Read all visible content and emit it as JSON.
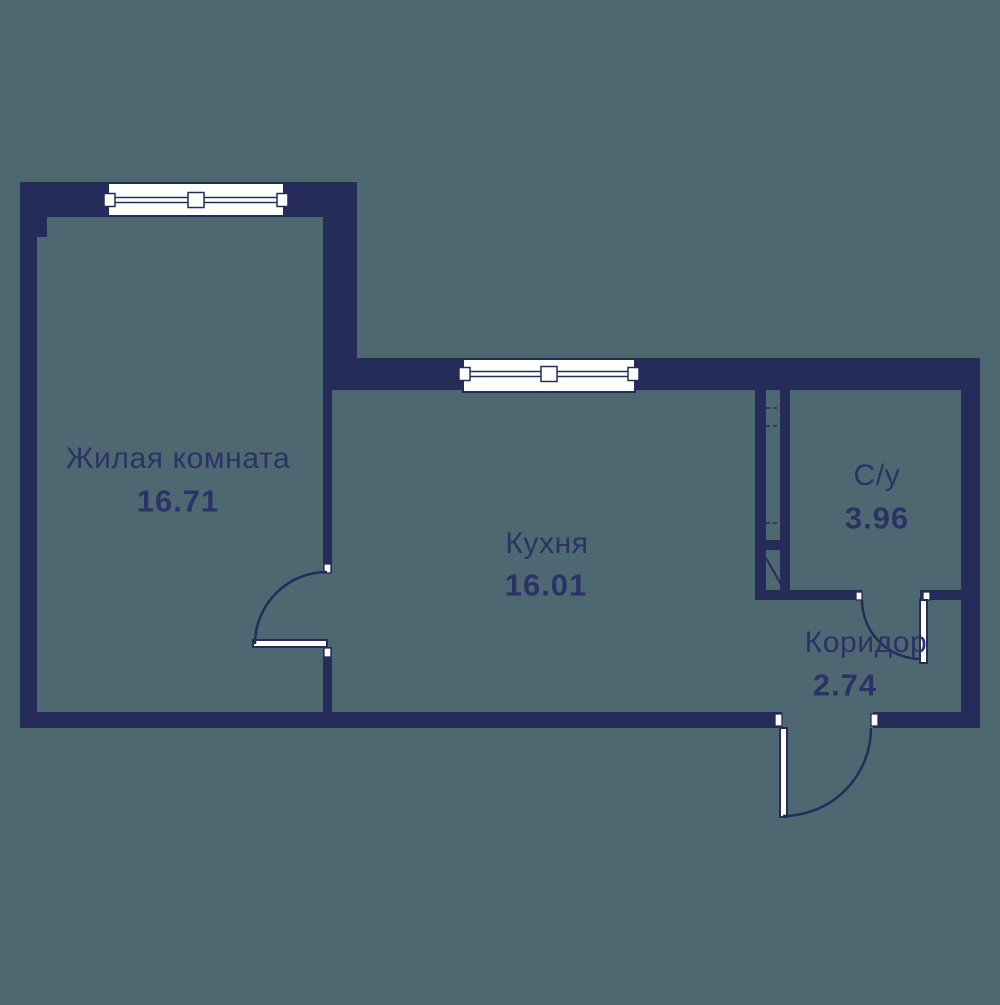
{
  "title": "Floor plan",
  "colors": {
    "background": "#4D6870",
    "wall": "#262C5A",
    "text": "#2B3366",
    "white": "#FFFFFF"
  },
  "rooms": {
    "living": {
      "name": "Жилая комната",
      "area": "16.71"
    },
    "kitchen": {
      "name": "Кухня",
      "area": "16.01"
    },
    "bath": {
      "name": "С/у",
      "area": "3.96"
    },
    "corridor": {
      "name": "Коридор",
      "area": "2.74"
    }
  },
  "plan": {
    "walls": [
      {
        "name": "wall-living-top",
        "x": 20,
        "y": 182,
        "w": 337,
        "h": 35
      },
      {
        "name": "wall-living-left",
        "x": 20,
        "y": 182,
        "w": 17,
        "h": 546
      },
      {
        "name": "wall-living-left-step",
        "x": 37,
        "y": 217,
        "w": 10,
        "h": 20
      },
      {
        "name": "wall-living-right-col",
        "x": 323,
        "y": 182,
        "w": 34,
        "h": 208
      },
      {
        "name": "wall-kitchen-top",
        "x": 323,
        "y": 358,
        "w": 657,
        "h": 32
      },
      {
        "name": "wall-divider-upper",
        "x": 323,
        "y": 390,
        "w": 9,
        "h": 183
      },
      {
        "name": "wall-divider-lower",
        "x": 323,
        "y": 647,
        "w": 9,
        "h": 65
      },
      {
        "name": "wall-bottom-left",
        "x": 20,
        "y": 712,
        "w": 762,
        "h": 16
      },
      {
        "name": "wall-bottom-right",
        "x": 873,
        "y": 712,
        "w": 107,
        "h": 16
      },
      {
        "name": "wall-right",
        "x": 961,
        "y": 390,
        "w": 19,
        "h": 338
      },
      {
        "name": "wall-shaft-left",
        "x": 755,
        "y": 390,
        "w": 11,
        "h": 210
      },
      {
        "name": "wall-shaft-right",
        "x": 780,
        "y": 390,
        "w": 10,
        "h": 210
      },
      {
        "name": "wall-shaft-bridge",
        "x": 755,
        "y": 540,
        "w": 35,
        "h": 10
      },
      {
        "name": "wall-bath-bottom-left",
        "x": 755,
        "y": 590,
        "w": 107,
        "h": 10
      },
      {
        "name": "wall-bath-bottom-right",
        "x": 920,
        "y": 590,
        "w": 60,
        "h": 10
      }
    ],
    "windows": [
      {
        "name": "window-living",
        "x": 108,
        "y": 183,
        "w": 176,
        "h": 33,
        "frame_y": 200
      },
      {
        "name": "window-kitchen",
        "x": 463,
        "y": 359,
        "w": 172,
        "h": 33,
        "frame_y": 374
      }
    ],
    "jambs": [
      {
        "name": "jamb-living-door-top",
        "x": 324,
        "y": 564,
        "w": 7,
        "h": 9
      },
      {
        "name": "jamb-living-door-bottom",
        "x": 324,
        "y": 648,
        "w": 7,
        "h": 9
      },
      {
        "name": "jamb-entrance-left",
        "x": 775,
        "y": 714,
        "w": 7,
        "h": 12
      },
      {
        "name": "jamb-entrance-right",
        "x": 871,
        "y": 714,
        "w": 7,
        "h": 12
      },
      {
        "name": "jamb-bath-left",
        "x": 856,
        "y": 592,
        "w": 6,
        "h": 8
      },
      {
        "name": "jamb-bath-right",
        "x": 923,
        "y": 592,
        "w": 7,
        "h": 8
      }
    ],
    "leaves": [
      {
        "name": "door-leaf-living",
        "x": 253,
        "y": 640,
        "w": 74,
        "h": 7
      },
      {
        "name": "door-leaf-bath",
        "x": 920,
        "y": 600,
        "w": 7,
        "h": 63
      },
      {
        "name": "door-leaf-entrance",
        "x": 780,
        "y": 728,
        "w": 7,
        "h": 89
      }
    ],
    "arcs": [
      {
        "name": "door-swing-living",
        "d": "M 255 644 A 72 72 0 0 1 327 572"
      },
      {
        "name": "door-swing-bath",
        "d": "M 862 600 A 59 59 0 0 0 921 659"
      },
      {
        "name": "door-swing-entrance",
        "d": "M 871 728 A 88 88 0 0 1 783 816"
      }
    ],
    "lines": [
      {
        "name": "vent-shaft-dash",
        "x1": 766,
        "y1": 408,
        "x2": 780,
        "y2": 408,
        "dash": "4 3",
        "w": 1.5
      },
      {
        "name": "vent-shaft-dash",
        "x1": 766,
        "y1": 426,
        "x2": 780,
        "y2": 426,
        "dash": "4 3",
        "w": 1.5
      },
      {
        "name": "vent-shaft-dash",
        "x1": 766,
        "y1": 523,
        "x2": 780,
        "y2": 523,
        "dash": "4 3",
        "w": 1.5
      },
      {
        "name": "vent-shaft-diagonal",
        "x1": 766,
        "y1": 558,
        "x2": 787,
        "y2": 595,
        "dash": "",
        "w": 2
      }
    ]
  }
}
